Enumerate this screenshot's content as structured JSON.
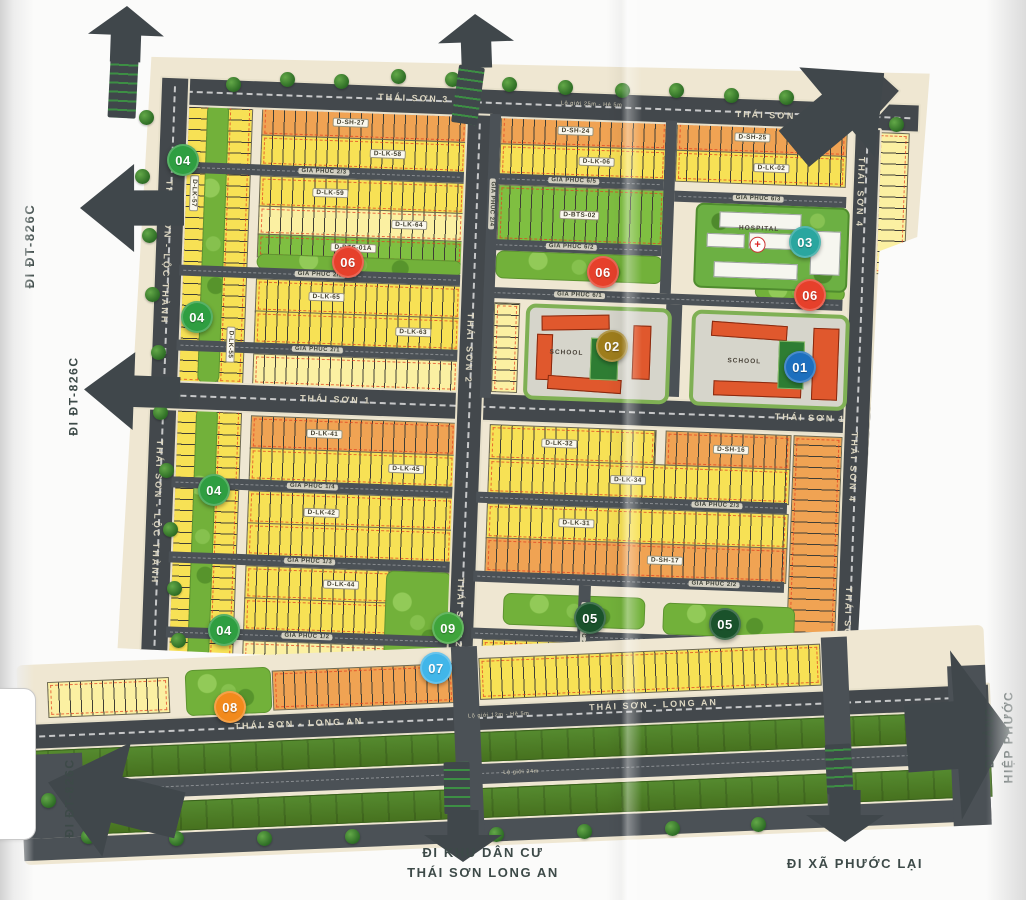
{
  "map": {
    "main_road_labels": [
      {
        "id": "ts3a",
        "text": "THÁI SƠN 3"
      },
      {
        "id": "ts3b",
        "text": "THÁI SƠN 3"
      },
      {
        "id": "ts1a",
        "text": "THÁI SƠN 1"
      },
      {
        "id": "ts1b",
        "text": "THÁI SƠN 1"
      },
      {
        "id": "ts2a",
        "text": "THÁI SƠN 2"
      },
      {
        "id": "ts2b",
        "text": "THÁI SƠN 2"
      },
      {
        "id": "ts4a",
        "text": "THÁI SƠN 4"
      },
      {
        "id": "ts4b",
        "text": "THÁI SƠN 4"
      },
      {
        "id": "ts4c",
        "text": "THÁI SƠN 4"
      },
      {
        "id": "tslta",
        "text": "THÁI SƠN - LỘC THÀNH"
      },
      {
        "id": "tsltb",
        "text": "THÁI SƠN - LỘC THÀNH"
      },
      {
        "id": "tslaa",
        "text": "THÁI SƠN - LONG AN"
      },
      {
        "id": "tslab",
        "text": "THÁI SƠN - LONG AN"
      }
    ],
    "minor_road_labels": [
      {
        "id": "gp23L",
        "text": "GIA PHÚC 2/3"
      },
      {
        "id": "gp22L",
        "text": "GIA PHÚC 2/2"
      },
      {
        "id": "gp21L",
        "text": "GIA PHÚC 2/1"
      },
      {
        "id": "gp65",
        "text": "GIA PHÚC 6/5"
      },
      {
        "id": "gp63",
        "text": "GIA PHÚC 6/3"
      },
      {
        "id": "gp62",
        "text": "GIA PHÚC 6/2"
      },
      {
        "id": "gp61",
        "text": "GIA PHÚC 6/1"
      },
      {
        "id": "gp14",
        "text": "GIA PHÚC 1/4"
      },
      {
        "id": "gp13",
        "text": "GIA PHÚC 1/3"
      },
      {
        "id": "gp12",
        "text": "GIA PHÚC 1/2"
      },
      {
        "id": "gp23R",
        "text": "GIA PHÚC 2/3"
      },
      {
        "id": "gp22R",
        "text": "GIA PHÚC 2/2"
      },
      {
        "id": "gp21R",
        "text": "GIA PHÚC 2/1"
      },
      {
        "id": "gp24",
        "text": "GIA PHÚC 2/4"
      },
      {
        "id": "gp25",
        "text": "GIA PHÚC 2/5"
      }
    ],
    "block_labels": [
      {
        "text": "D-SH-27"
      },
      {
        "text": "D-LK-58"
      },
      {
        "text": "D-LK-59"
      },
      {
        "text": "D-LK-64"
      },
      {
        "text": "D-BTS-01A"
      },
      {
        "text": "D-LK-65"
      },
      {
        "text": "D-LK-63"
      },
      {
        "text": "D-SH-24"
      },
      {
        "text": "D-LK-06"
      },
      {
        "text": "D-SH-25"
      },
      {
        "text": "D-LK-02"
      },
      {
        "text": "D-BTS-02"
      },
      {
        "text": "D-LK-41"
      },
      {
        "text": "D-LK-45"
      },
      {
        "text": "D-LK-42"
      },
      {
        "text": "D-LK-44"
      },
      {
        "text": "D-LK-32"
      },
      {
        "text": "D-SH-16"
      },
      {
        "text": "D-LK-34"
      },
      {
        "text": "D-LK-31"
      },
      {
        "text": "D-SH-17"
      },
      {
        "text": "D-LK-30"
      },
      {
        "text": "D-SH-12A"
      },
      {
        "text": "D-LK-57"
      },
      {
        "text": "D-LK-55"
      }
    ],
    "markers": [
      {
        "id": "m01",
        "num": "01",
        "color": "#1d6fbe"
      },
      {
        "id": "m02",
        "num": "02",
        "color": "#9e7d1c"
      },
      {
        "id": "m03",
        "num": "03",
        "color": "#2aa69f"
      },
      {
        "id": "m04a",
        "num": "04",
        "color": "#2f9e41"
      },
      {
        "id": "m04b",
        "num": "04",
        "color": "#2f9e41"
      },
      {
        "id": "m04c",
        "num": "04",
        "color": "#2f9e41"
      },
      {
        "id": "m04d",
        "num": "04",
        "color": "#2f9e41"
      },
      {
        "id": "m05a",
        "num": "05",
        "color": "#1a522b"
      },
      {
        "id": "m05b",
        "num": "05",
        "color": "#1a522b"
      },
      {
        "id": "m06a",
        "num": "06",
        "color": "#e6402b"
      },
      {
        "id": "m06b",
        "num": "06",
        "color": "#e6402b"
      },
      {
        "id": "m06c",
        "num": "06",
        "color": "#e6402b"
      },
      {
        "id": "m07",
        "num": "07",
        "color": "#41b6e9"
      },
      {
        "id": "m08",
        "num": "08",
        "color": "#f28a1c"
      },
      {
        "id": "m09",
        "num": "09",
        "color": "#3fa43b"
      }
    ],
    "amenities": [
      {
        "id": "school_w",
        "label": "SCHOOL"
      },
      {
        "id": "school_e",
        "label": "SCHOOL"
      },
      {
        "id": "hospital",
        "label": "HOSPITAL",
        "cross": "+"
      }
    ],
    "exits": [
      {
        "id": "x826top",
        "lines": [
          "ĐI ĐT-826C"
        ]
      },
      {
        "id": "x826mid",
        "lines": [
          "ĐI ĐT-826C"
        ]
      },
      {
        "id": "x826bot",
        "lines": [
          "ĐI ĐT-826C"
        ]
      },
      {
        "id": "xcang",
        "lines": [
          "ĐI CẢNG",
          "HIỆP PHƯỚC"
        ]
      },
      {
        "id": "xkdc",
        "lines": [
          "ĐI KHU DÂN CƯ",
          "THÁI SƠN LONG AN"
        ]
      },
      {
        "id": "xpl",
        "lines": [
          "ĐI XÃ PHƯỚC LẠI"
        ]
      }
    ],
    "road_notes": [
      {
        "id": "n1",
        "text": "Lộ giới 25m - Hè 5m"
      },
      {
        "id": "n2",
        "text": "Lộ giới 24m"
      },
      {
        "id": "n3",
        "text": "Lộ giới 12m - Hè 5m"
      }
    ]
  },
  "colors": {
    "road": "#43484c",
    "minor_road": "#4b5156",
    "land": "#efe7d2",
    "lot_yellow": "#f7e155",
    "lot_pale": "#fbf0a2",
    "lot_orange": "#f0a353",
    "lot_villa": "#7fbf41",
    "park": "#72b13a",
    "median": "#4e7d2b"
  }
}
